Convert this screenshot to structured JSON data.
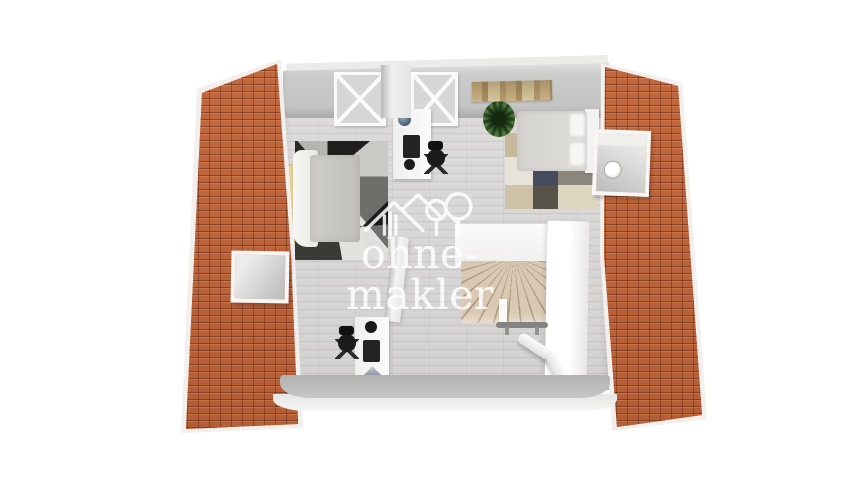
{
  "watermark": {
    "text": "ohne-makler",
    "logo": "house-and-trees-icon",
    "text_color": "#ffffff"
  },
  "palette": {
    "background": "#ffffff",
    "roof_tiles": "#b85f38",
    "roof_tile_shadow": "#7e3e20",
    "roof_trim_white": "#f2efec",
    "wood_floor": "#d8d7d5",
    "walls_gray": "#c6c6c5",
    "stairs_beige": "#dac9b2",
    "pillow_yellow": "#ead9a1",
    "rug_left_dark": "#2e2e2c",
    "rug_right_beige": "#c6b99e",
    "rug_right_navy": "#434b5c",
    "plant_green": "#4d7a3c",
    "furniture_white": "#f6f6f5",
    "chair_black": "#1b1b1a",
    "handrail_gray": "#83837f",
    "artwork_tan": "#c9b183"
  }
}
